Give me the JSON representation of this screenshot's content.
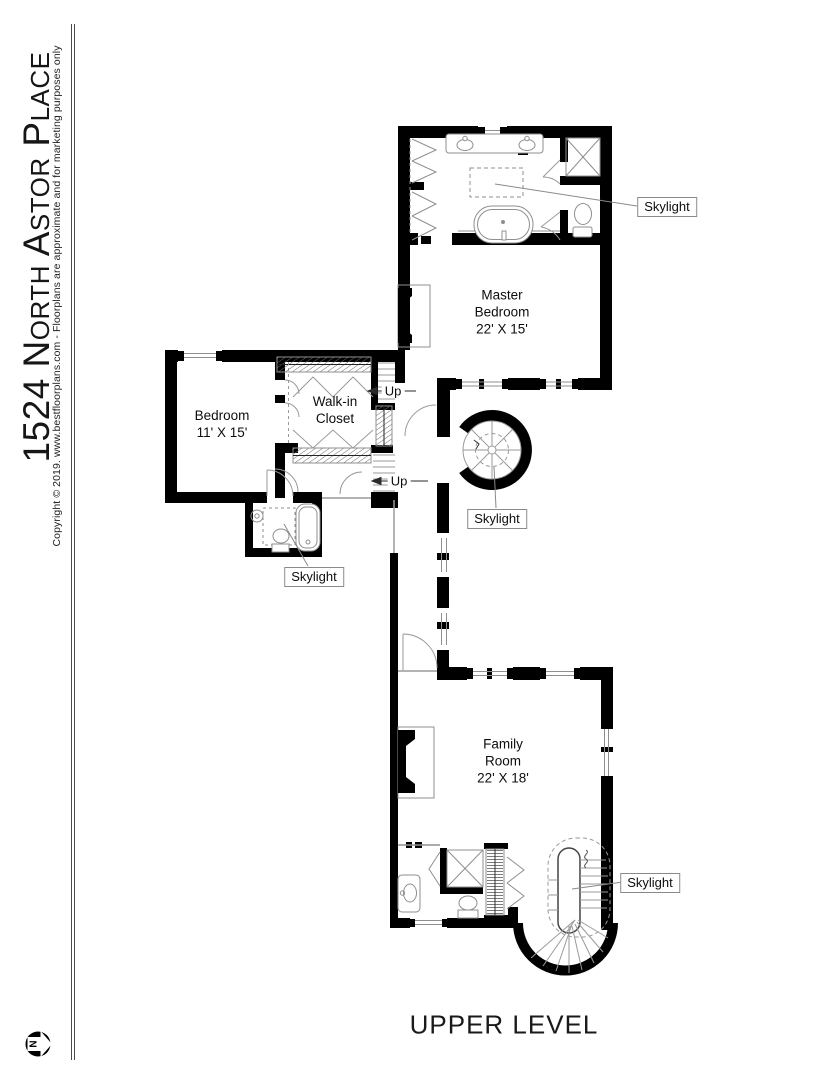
{
  "sidebar": {
    "title": "1524 North Astor Place",
    "copyright": "Copyright © 2019. www.bestfloorplans.com - Floorplans are approximate and for marketing purposes only"
  },
  "rooms": {
    "master_bedroom": {
      "line1": "Master",
      "line2": "Bedroom",
      "dims": "22' X 15'"
    },
    "bedroom": {
      "line1": "Bedroom",
      "dims": "11' X 15'"
    },
    "walkin_closet": {
      "line1": "Walk-in",
      "line2": "Closet"
    },
    "family_room": {
      "line1": "Family",
      "line2": "Room",
      "dims": "22' X 18'"
    }
  },
  "labels": {
    "skylight": "Skylight",
    "up": "Up",
    "level_title": "UPPER LEVEL",
    "north": "N"
  },
  "colors": {
    "wall": "#000000",
    "fixture": "#8f8f8f",
    "leader": "#8a8a8a",
    "text": "#111111"
  }
}
